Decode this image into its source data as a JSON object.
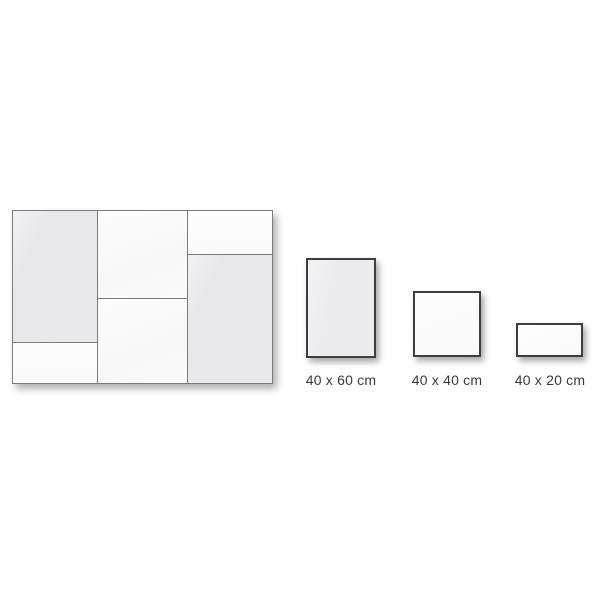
{
  "diagram": {
    "title_implied": "panel size options",
    "composite_layout": {
      "panels": [
        {
          "position": "left-top",
          "size": "40 x 60"
        },
        {
          "position": "left-bottom",
          "size": "40 x 20"
        },
        {
          "position": "middle-top",
          "size": "40 x 40"
        },
        {
          "position": "middle-bottom",
          "size": "40 x 40"
        },
        {
          "position": "right-top",
          "size": "40 x 20"
        },
        {
          "position": "right-bottom",
          "size": "40 x 60"
        }
      ]
    },
    "size_options": [
      {
        "label": "40 x 60 cm",
        "shape": "portrait-rectangle"
      },
      {
        "label": "40 x 40 cm",
        "shape": "square"
      },
      {
        "label": "40 x 20 cm",
        "shape": "landscape-rectangle"
      }
    ],
    "colors": {
      "background": "#ffffff",
      "panel_fill_gray": "#e9e9eb",
      "panel_fill_white": "#fbfbfb",
      "composite_border": "#7b7b7b",
      "option_border": "#3e3e3e",
      "label_text": "#3a3a3a"
    }
  }
}
